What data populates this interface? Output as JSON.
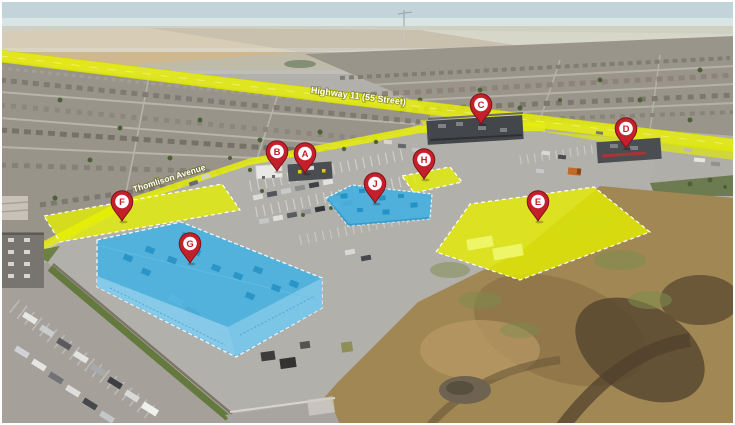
{
  "scene": {
    "description": "Aerial drone photo of a commercial development site with highlighted parcels and lettered location pins"
  },
  "roads": {
    "highway_label": "Highway 11 (55 Street)",
    "avenue_label": "Thomlison Avenue"
  },
  "pins": [
    {
      "label": "A"
    },
    {
      "label": "B"
    },
    {
      "label": "C"
    },
    {
      "label": "D"
    },
    {
      "label": "E"
    },
    {
      "label": "F"
    },
    {
      "label": "G"
    },
    {
      "label": "H"
    },
    {
      "label": "J"
    }
  ],
  "colors": {
    "pin_red": "#c4202b",
    "highlight_yellow": "#e6ef00",
    "highlight_blue": "#44b0e0"
  }
}
